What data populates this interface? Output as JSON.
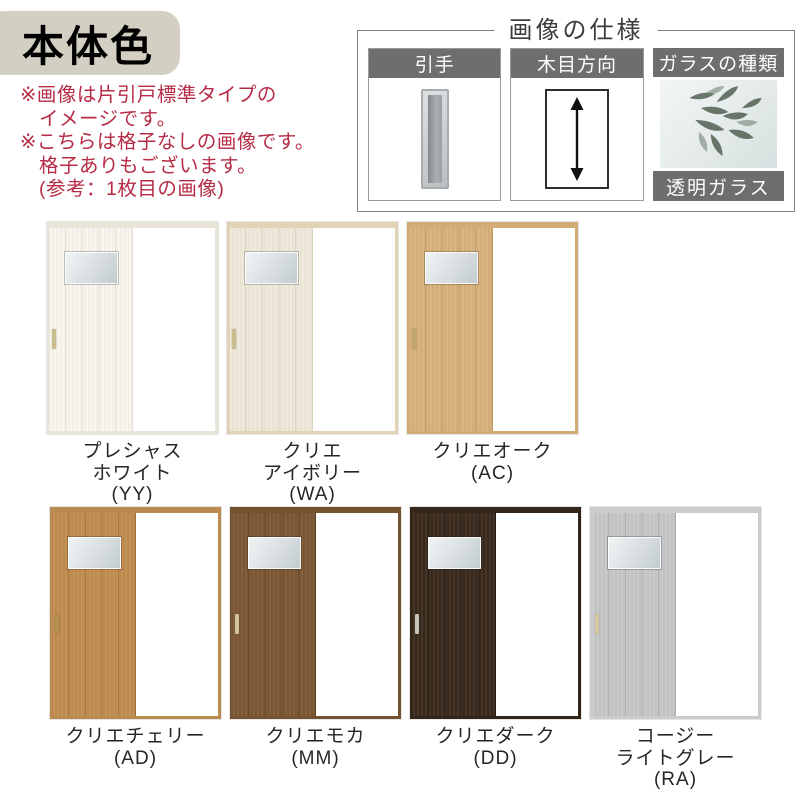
{
  "badge": {
    "label": "本体色",
    "bg": "#d3cfc2",
    "text_color": "#000000"
  },
  "notes": {
    "text_color": "#b62b45",
    "lines": [
      {
        "text": "※画像は片引戸標準タイプの",
        "indent": false
      },
      {
        "text": "イメージです。",
        "indent": true
      },
      {
        "text": "※こちらは格子なしの画像です。",
        "indent": false
      },
      {
        "text": "格子ありもございます。",
        "indent": true
      },
      {
        "text": "(参考：1枚目の画像)",
        "indent": true
      }
    ]
  },
  "spec_box": {
    "title": "画像の仕様",
    "header_bg": "#6e6e6e",
    "panels": [
      {
        "label": "引手",
        "icon": "recessed-pull-handle"
      },
      {
        "label": "木目方向",
        "icon": "vertical-double-arrow"
      },
      {
        "label": "ガラスの種類",
        "icon": "glass-with-plant-photo",
        "footer": "透明ガラス"
      }
    ]
  },
  "door_rows": [
    {
      "doors": [
        {
          "name_lines": [
            "プレシャス",
            "ホワイト"
          ],
          "code": "(YY)",
          "colors": {
            "door": "#f7f5ee",
            "groove": "#e2dfd2",
            "frame": "#e9e5d9",
            "handle": "#c9bd8e"
          }
        },
        {
          "name_lines": [
            "クリエ",
            "アイボリー"
          ],
          "code": "(WA)",
          "colors": {
            "door": "#efe9db",
            "groove": "#dcd2bd",
            "frame": "#e0d3b6",
            "handle": "#c9bd8e"
          }
        },
        {
          "name_lines": [
            "クリエオーク"
          ],
          "code": "(AC)",
          "colors": {
            "door": "#d8b17c",
            "groove": "#bf9960",
            "frame": "#d2ab75",
            "handle": "#c0a66c"
          }
        }
      ]
    },
    {
      "doors": [
        {
          "name_lines": [
            "クリエチェリー"
          ],
          "code": "(AD)",
          "colors": {
            "door": "#c18c50",
            "groove": "#a1713a",
            "frame": "#bb8a51",
            "handle": "#b2934e"
          }
        },
        {
          "name_lines": [
            "クリエモカ"
          ],
          "code": "(MM)",
          "colors": {
            "door": "#7c5733",
            "groove": "#61401f",
            "frame": "#745331",
            "handle": "#cfc49e"
          }
        },
        {
          "name_lines": [
            "クリエダーク"
          ],
          "code": "(DD)",
          "colors": {
            "door": "#3a2a1d",
            "groove": "#251910",
            "frame": "#342519",
            "handle": "#c6c6b8"
          }
        },
        {
          "name_lines": [
            "コージー",
            "ライトグレー"
          ],
          "code": "(RA)",
          "colors": {
            "door": "#c5c6c8",
            "groove": "#acadaf",
            "frame": "#cbccce",
            "handle": "#d4c99e"
          }
        }
      ]
    }
  ]
}
